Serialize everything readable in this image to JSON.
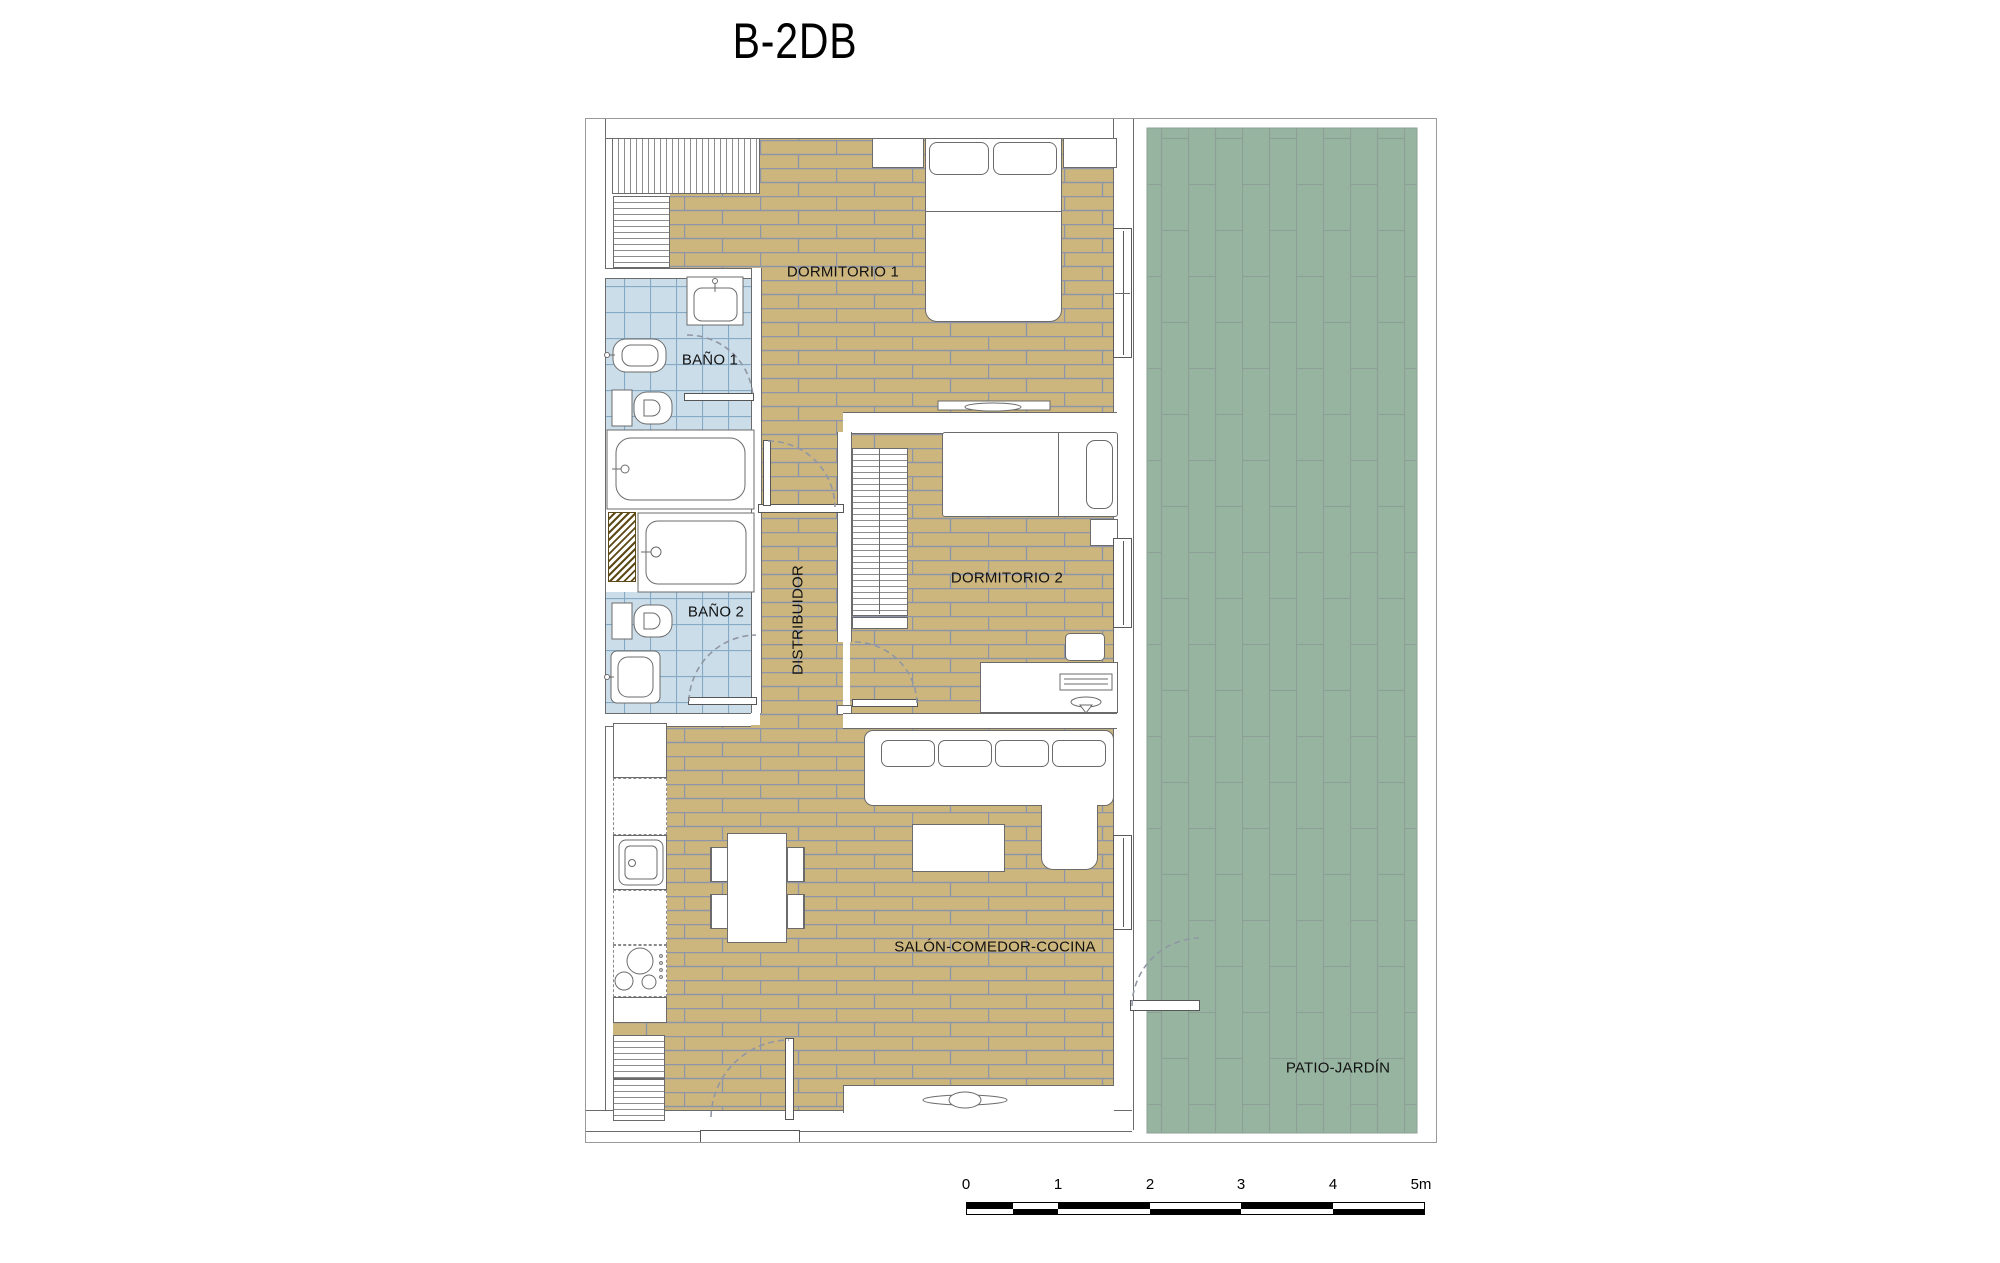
{
  "title": "B-2DB",
  "rooms": {
    "dormitorio1": "DORMITORIO 1",
    "bano1": "BAÑO 1",
    "bano2": "BAÑO 2",
    "distribuidor": "DISTRIBUIDOR",
    "dormitorio2": "DORMITORIO 2",
    "salon": "SALÓN-COMEDOR-COCINA",
    "patio": "PATIO-JARDÍN"
  },
  "scale_bar": {
    "labels": [
      "0",
      "1",
      "2",
      "3",
      "4",
      "5m"
    ],
    "total_meters": 5
  },
  "colors": {
    "wood_floor": "#cdb67e",
    "wood_joint": "#8e95a8",
    "bath_tile": "#cbdde9",
    "bath_tile_line": "#86a9c6",
    "patio_tile": "#97b4a1",
    "patio_joint": "#8da095",
    "wall_line": "#6b6b6b",
    "background": "#ffffff"
  }
}
